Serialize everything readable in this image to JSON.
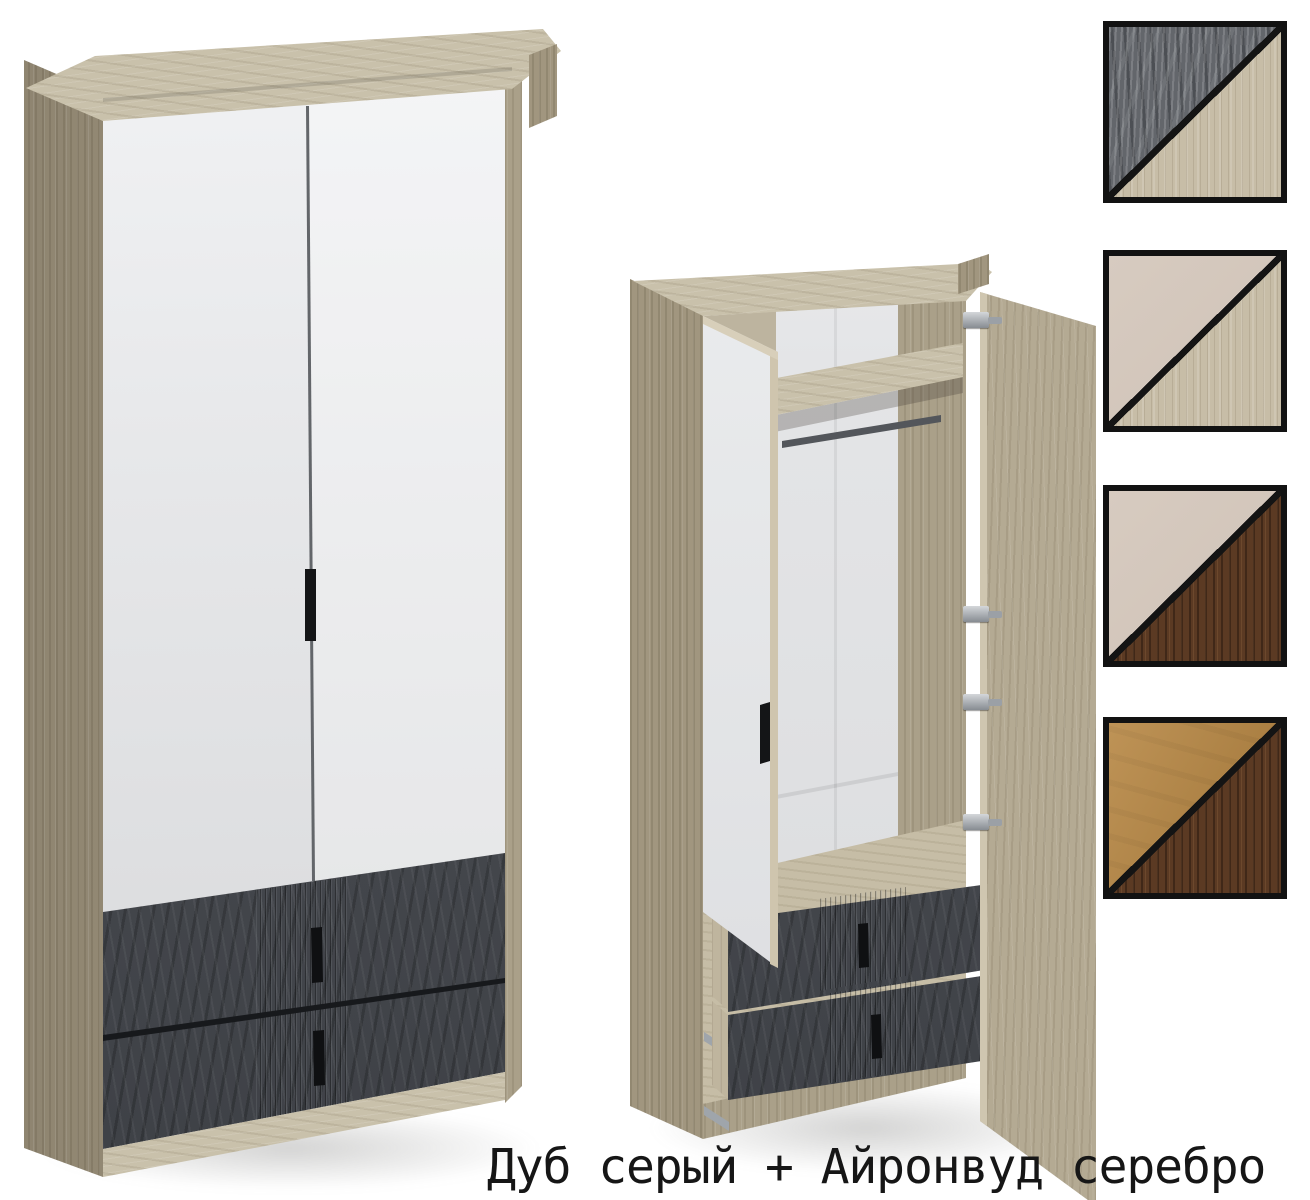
{
  "caption": {
    "text": "Дуб серый + Айронвуд серебро"
  },
  "palette": {
    "background": "#ffffff",
    "carcass_wood": "#aaa089",
    "carcass_wood_top": "#c9c1ab",
    "door_front": "#e8e9eb",
    "open_door_inner": "#eef0f1",
    "drawer_front": "#45484e",
    "handle": "#141517",
    "hinge": "#b9bec4",
    "hanging_rod": "#53565b",
    "swatch_border": "#121212",
    "caption_text": "#161616"
  },
  "materials": {
    "ironwood-silver": "#63666b",
    "oak-grey": "#c7bda7",
    "cashmere": "#d2c5ba",
    "oak-dark": "#5b3a23",
    "camel": "#b5843f"
  },
  "swatches": [
    {
      "name": "swatch-1",
      "top_left": "ironwood-silver",
      "bottom_right": "oak-grey"
    },
    {
      "name": "swatch-2",
      "top_left": "cashmere",
      "bottom_right": "oak-grey"
    },
    {
      "name": "swatch-3",
      "top_left": "cashmere",
      "bottom_right": "oak-dark"
    },
    {
      "name": "swatch-4",
      "top_left": "camel",
      "bottom_right": "oak-dark"
    }
  ]
}
